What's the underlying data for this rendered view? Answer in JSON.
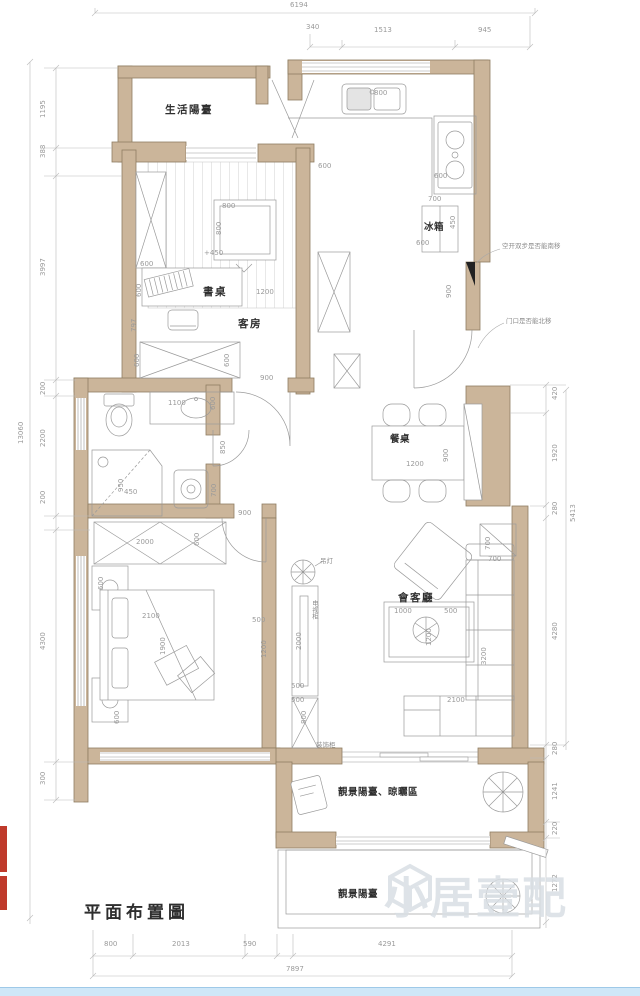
{
  "title": {
    "text": "平面布置圖"
  },
  "watermark": {
    "text": "小居壹配"
  },
  "colors": {
    "wall": "#cbb59a",
    "wall-border": "#8f7e62",
    "line": "#9a9a9a",
    "dim": "#9a9a9a",
    "label": "#2f2f2f",
    "note": "#8d8d8d",
    "watermark": "#d9dfe4",
    "seal": "#bf3a2b",
    "bottom-bar": "#cfe7f8"
  },
  "labels": [
    {
      "t": "6194",
      "x": 290,
      "y": 2,
      "c": "d"
    },
    {
      "t": "340",
      "x": 306,
      "y": 24,
      "c": "d"
    },
    {
      "t": "1513",
      "x": 374,
      "y": 27,
      "c": "d"
    },
    {
      "t": "945",
      "x": 478,
      "y": 27,
      "c": "d"
    },
    {
      "t": "800",
      "x": 374,
      "y": 90,
      "c": "d"
    },
    {
      "t": "600",
      "x": 318,
      "y": 163,
      "c": "d"
    },
    {
      "t": "600",
      "x": 434,
      "y": 173,
      "c": "d"
    },
    {
      "t": "700",
      "x": 428,
      "y": 196,
      "c": "d"
    },
    {
      "t": "600",
      "x": 416,
      "y": 240,
      "c": "d"
    },
    {
      "t": "800",
      "x": 222,
      "y": 203,
      "c": "d"
    },
    {
      "t": "+450",
      "x": 204,
      "y": 250,
      "c": "d"
    },
    {
      "t": "600",
      "x": 140,
      "y": 261,
      "c": "d"
    },
    {
      "t": "1200",
      "x": 256,
      "y": 289,
      "c": "d"
    },
    {
      "t": "900",
      "x": 260,
      "y": 375,
      "c": "d"
    },
    {
      "t": "1100",
      "x": 168,
      "y": 400,
      "c": "d"
    },
    {
      "t": "450",
      "x": 124,
      "y": 489,
      "c": "d"
    },
    {
      "t": "900",
      "x": 238,
      "y": 510,
      "c": "d"
    },
    {
      "t": "2000",
      "x": 136,
      "y": 539,
      "c": "d"
    },
    {
      "t": "2100",
      "x": 142,
      "y": 613,
      "c": "d"
    },
    {
      "t": "500",
      "x": 252,
      "y": 617,
      "c": "d"
    },
    {
      "t": "1200",
      "x": 406,
      "y": 461,
      "c": "d"
    },
    {
      "t": "500",
      "x": 291,
      "y": 683,
      "c": "d"
    },
    {
      "t": "500",
      "x": 291,
      "y": 697,
      "c": "d"
    },
    {
      "t": "1000",
      "x": 394,
      "y": 608,
      "c": "d"
    },
    {
      "t": "500",
      "x": 444,
      "y": 608,
      "c": "d"
    },
    {
      "t": "2100",
      "x": 447,
      "y": 697,
      "c": "d"
    },
    {
      "t": "700",
      "x": 488,
      "y": 556,
      "c": "d"
    },
    {
      "t": "800",
      "x": 104,
      "y": 941,
      "c": "d"
    },
    {
      "t": "2013",
      "x": 172,
      "y": 941,
      "c": "d"
    },
    {
      "t": "590",
      "x": 243,
      "y": 941,
      "c": "d"
    },
    {
      "t": "4291",
      "x": 378,
      "y": 941,
      "c": "d"
    },
    {
      "t": "7897",
      "x": 286,
      "y": 966,
      "c": "d"
    },
    {
      "t": "13060",
      "x": 18,
      "y": 444,
      "c": "dv"
    },
    {
      "t": "1195",
      "x": 40,
      "y": 118,
      "c": "dv"
    },
    {
      "t": "388",
      "x": 40,
      "y": 158,
      "c": "dv"
    },
    {
      "t": "3997",
      "x": 40,
      "y": 276,
      "c": "dv"
    },
    {
      "t": "200",
      "x": 40,
      "y": 395,
      "c": "dv"
    },
    {
      "t": "2200",
      "x": 40,
      "y": 447,
      "c": "dv"
    },
    {
      "t": "200",
      "x": 40,
      "y": 504,
      "c": "dv"
    },
    {
      "t": "4300",
      "x": 40,
      "y": 650,
      "c": "dv"
    },
    {
      "t": "300",
      "x": 40,
      "y": 785,
      "c": "dv"
    },
    {
      "t": "420",
      "x": 552,
      "y": 400,
      "c": "dv"
    },
    {
      "t": "1920",
      "x": 552,
      "y": 462,
      "c": "dv"
    },
    {
      "t": "280",
      "x": 552,
      "y": 515,
      "c": "dv"
    },
    {
      "t": "5413",
      "x": 570,
      "y": 522,
      "c": "dv"
    },
    {
      "t": "4280",
      "x": 552,
      "y": 640,
      "c": "dv"
    },
    {
      "t": "280",
      "x": 552,
      "y": 755,
      "c": "dv"
    },
    {
      "t": "1241",
      "x": 552,
      "y": 800,
      "c": "dv"
    },
    {
      "t": "220",
      "x": 552,
      "y": 835,
      "c": "dv"
    },
    {
      "t": "1272",
      "x": 552,
      "y": 892,
      "c": "dv"
    },
    {
      "t": "450",
      "x": 450,
      "y": 229,
      "c": "dv"
    },
    {
      "t": "900",
      "x": 446,
      "y": 298,
      "c": "dv"
    },
    {
      "t": "800",
      "x": 216,
      "y": 235,
      "c": "dv"
    },
    {
      "t": "600",
      "x": 136,
      "y": 297,
      "c": "dv"
    },
    {
      "t": "797",
      "x": 131,
      "y": 332,
      "c": "dv"
    },
    {
      "t": "600",
      "x": 134,
      "y": 367,
      "c": "dv"
    },
    {
      "t": "600",
      "x": 224,
      "y": 367,
      "c": "dv"
    },
    {
      "t": "600",
      "x": 210,
      "y": 410,
      "c": "dv"
    },
    {
      "t": "850",
      "x": 220,
      "y": 454,
      "c": "dv"
    },
    {
      "t": "950",
      "x": 118,
      "y": 492,
      "c": "dv"
    },
    {
      "t": "700",
      "x": 211,
      "y": 497,
      "c": "dv"
    },
    {
      "t": "600",
      "x": 194,
      "y": 546,
      "c": "dv"
    },
    {
      "t": "600",
      "x": 98,
      "y": 590,
      "c": "dv"
    },
    {
      "t": "1900",
      "x": 160,
      "y": 655,
      "c": "dv"
    },
    {
      "t": "600",
      "x": 114,
      "y": 724,
      "c": "dv"
    },
    {
      "t": "1200",
      "x": 261,
      "y": 658,
      "c": "dv"
    },
    {
      "t": "2000",
      "x": 296,
      "y": 650,
      "c": "dv"
    },
    {
      "t": "800",
      "x": 301,
      "y": 724,
      "c": "dv"
    },
    {
      "t": "1200",
      "x": 426,
      "y": 646,
      "c": "dv"
    },
    {
      "t": "3200",
      "x": 481,
      "y": 665,
      "c": "dv"
    },
    {
      "t": "700",
      "x": 485,
      "y": 550,
      "c": "dv"
    },
    {
      "t": "900",
      "x": 443,
      "y": 462,
      "c": "dv"
    },
    {
      "t": "生活陽臺",
      "x": 165,
      "y": 102,
      "c": "r"
    },
    {
      "t": "書桌",
      "x": 203,
      "y": 284,
      "c": "r"
    },
    {
      "t": "客房",
      "x": 238,
      "y": 316,
      "c": "r"
    },
    {
      "t": "冰箱",
      "x": 424,
      "y": 219,
      "c": "r rs"
    },
    {
      "t": "餐桌",
      "x": 390,
      "y": 431,
      "c": "r rs"
    },
    {
      "t": "會客廳",
      "x": 398,
      "y": 590,
      "c": "r"
    },
    {
      "t": "靚景陽臺、晾曬區",
      "x": 338,
      "y": 784,
      "c": "r rs"
    },
    {
      "t": "靚景陽臺",
      "x": 338,
      "y": 886,
      "c": "r rs"
    },
    {
      "t": "吊灯",
      "x": 320,
      "y": 558,
      "c": "n"
    },
    {
      "t": "装饰柜",
      "x": 316,
      "y": 742,
      "c": "n"
    },
    {
      "t": "电视柜",
      "x": 311,
      "y": 600,
      "c": "nv"
    },
    {
      "t": "空开双步是否能南移",
      "x": 502,
      "y": 243,
      "c": "n"
    },
    {
      "t": "门口是否能北移",
      "x": 506,
      "y": 318,
      "c": "n"
    }
  ]
}
